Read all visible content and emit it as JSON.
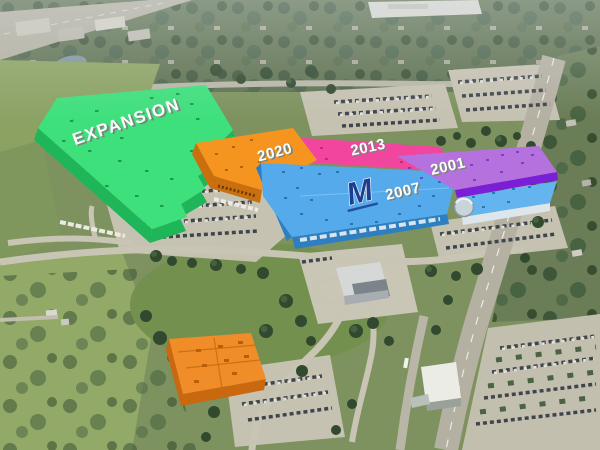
{
  "annotations": {
    "expansion": {
      "label": "EXPANSION",
      "roof_color": "#3ee07c",
      "wall_color": "#1fb65a",
      "vent_color": "#128a48"
    },
    "phase_2020": {
      "label": "2020",
      "roof_color": "#f5941f",
      "wall_color": "#c96f0e",
      "vent_color": "#a85e06"
    },
    "phase_2013": {
      "label": "2013",
      "roof_color": "#f2469e",
      "wall_color": "#d4328a",
      "vent_color": "#b52371"
    },
    "phase_2001": {
      "label": "2001",
      "roof_color": "#b571dd",
      "wall_color": "#7b1ed8",
      "vent_color": "#7a2fc0"
    },
    "phase_2007": {
      "label": "2007",
      "logo": "M",
      "roof_color": "#55aaec",
      "annex_color": "#64b4ef",
      "wall_color": "#2d7fc2",
      "logo_color": "#1c3e90",
      "vent_color": "#1d6aa8"
    },
    "outbuilding": {
      "roof_color": "#f08d28",
      "wall_color": "#c9680f"
    }
  },
  "label_style": {
    "fill": "#ffffff",
    "shadow": "#79857d"
  }
}
